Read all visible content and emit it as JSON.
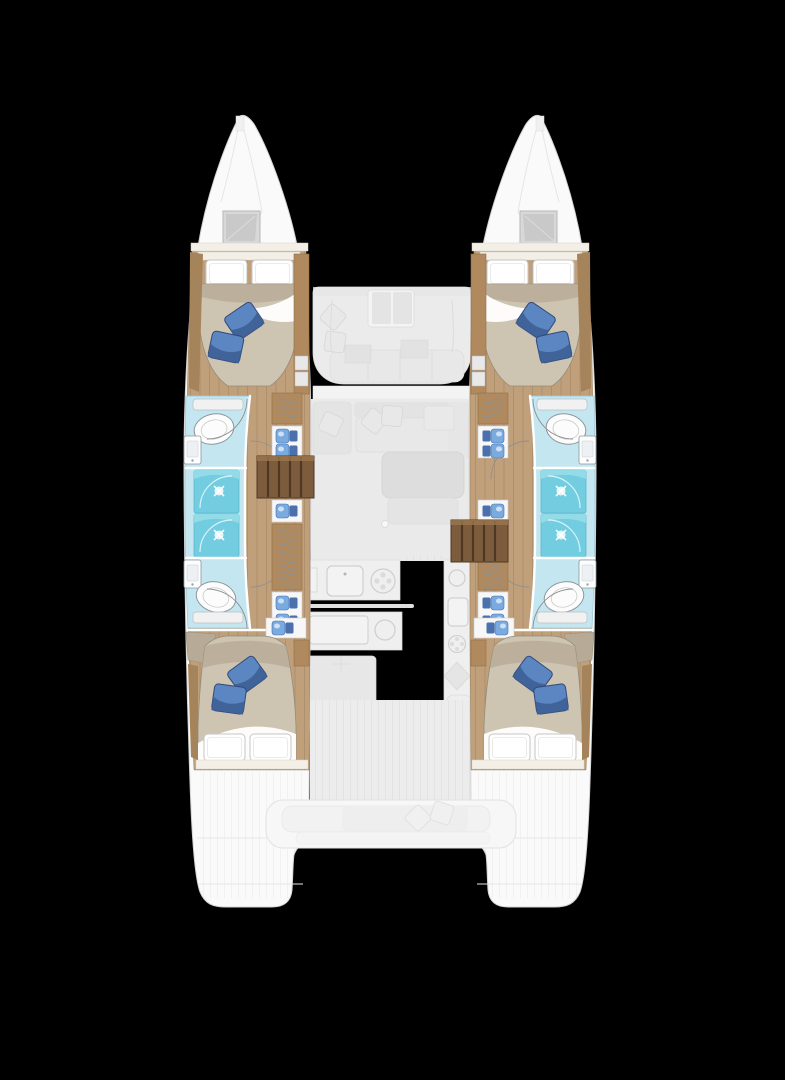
{
  "title": "Catamaran interior deck plan",
  "view": "Top-down interior floor plan of a twin-hull sailing catamaran on black background",
  "colors": {
    "background": "#000000",
    "hull": "#fafafa",
    "hullLine": "#d4d4d4",
    "wood": "#c0a07b",
    "woodDark": "#a5845c",
    "woodLine": "#8f6f48",
    "cabinet": "#b08a5e",
    "steps": "#7d5c3d",
    "stepsLine": "#4e3823",
    "stepsHi": "#9a774f",
    "mattress": "#cec4b2",
    "mattressShade": "#b5aa95",
    "bedLine": "#948c7a",
    "bulkhead": "#f3efe7",
    "linenLine": "#c6c6c6",
    "pillow": "#5b86c1",
    "pillowDark": "#3c5d92",
    "pillowLine": "#30497a",
    "bathFloor": "#c4e6f0",
    "bathLine": "#9cc7d4",
    "shower": "#72cde1",
    "showerHi": "#9adde9",
    "gear": "#79abdf",
    "gearDark": "#4a71ad",
    "ghost": "#f3f3f3",
    "ghostAlt": "#ececec",
    "ghostLine": "#e1e1e1",
    "fixtureLine": "#8e969b",
    "doorLine": "#8f8f8f",
    "squiggle": "#8a9095",
    "hatchA": "#d8d8d8",
    "hatchB": "#c9c9c9",
    "hatchLine": "#b7b7b7"
  },
  "plan": {
    "vessel": "sailing catamaran, 4-cabin layout",
    "port_hull_label": "port hull: foredeck hatch, forward double cabin, forward head with shower, twin shower compartments, aft head, companionway stairs with storage, aft double cabin, transom swim platform",
    "starboard_hull_label": "starboard hull: mirror of port hull",
    "bridgedeck_label": "bridgedeck: forward cockpit seating with table, saloon sofa and table, galley counters with sinks and burners, aft cockpit bench with cushions",
    "counts": {
      "double_berths": 4,
      "toilets": 4,
      "shower_compartments": 4,
      "deck_hatches": 2,
      "blue_accent_pillows": 8
    }
  }
}
